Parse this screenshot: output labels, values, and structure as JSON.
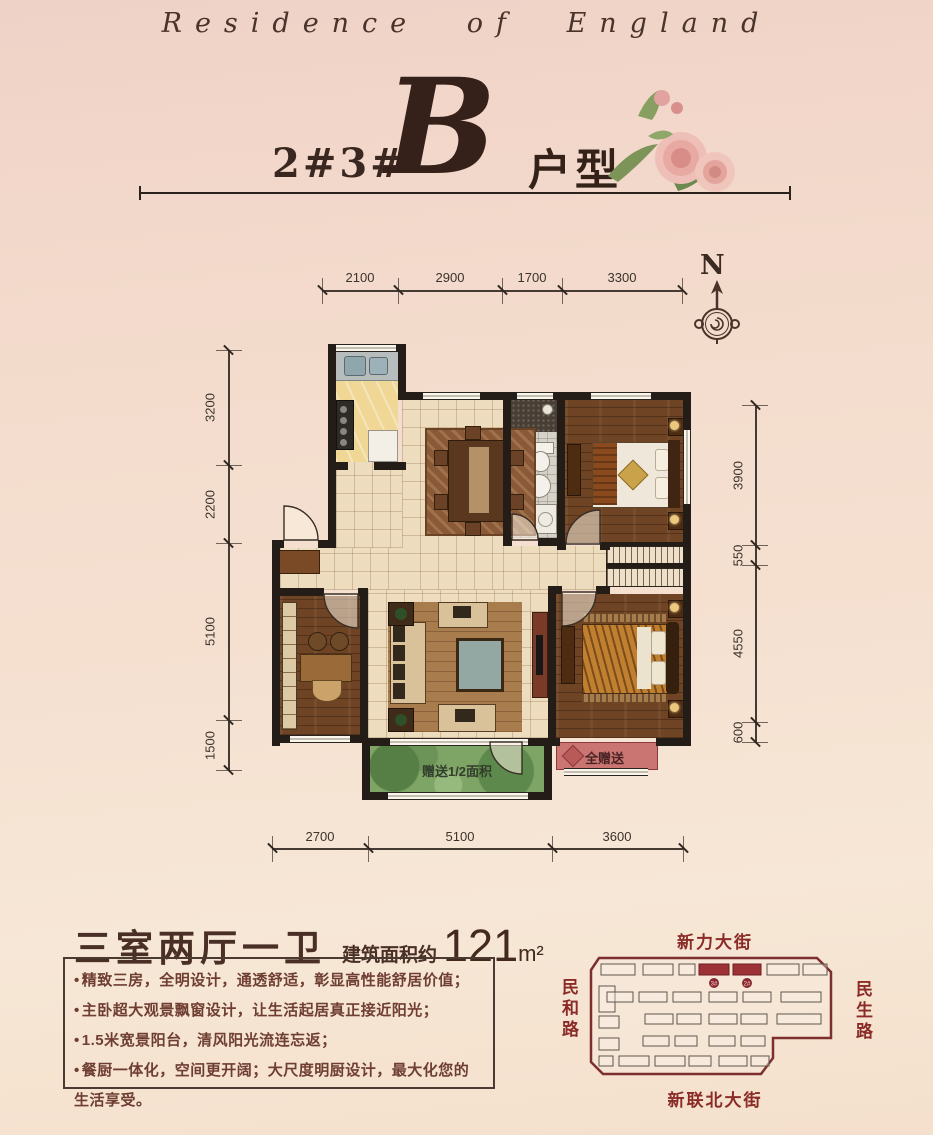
{
  "header": {
    "brand": "Residence of England"
  },
  "title": {
    "prefix": "2#3#",
    "letter": "B",
    "suffix": "户型"
  },
  "compass": {
    "label": "N"
  },
  "dimensions": {
    "top": [
      "2100",
      "2900",
      "1700",
      "3300"
    ],
    "left": [
      "3200",
      "2200",
      "5100",
      "1500"
    ],
    "right": [
      "3900",
      "550",
      "4550",
      "600"
    ],
    "bottom": [
      "2700",
      "5100",
      "3600"
    ]
  },
  "plan": {
    "balcony_label": "赠送1/2面积",
    "bay_window_label": "全赠送"
  },
  "summary": {
    "layout": "三室两厅一卫",
    "area_prefix": "建筑面积约",
    "area_value": "121",
    "area_unit": "m²"
  },
  "features": [
    "精致三房，全明设计，通透舒适，彰显高性能舒居价值；",
    "主卧超大观景飘窗设计，让生活起居真正接近阳光；",
    "1.5米宽景阳台，清风阳光流连忘返；",
    "餐厨一体化，空间更开阔；大尺度明厨设计，最大化您的生活享受。"
  ],
  "sitemap": {
    "street_top": "新力大街",
    "street_bottom": "新联北大街",
    "street_left": "民和路",
    "street_right": "民生路",
    "highlight_buildings": [
      "3#",
      "2#"
    ]
  },
  "colors": {
    "accent_red": "#9c3136",
    "wall": "#241d17",
    "balcony_green": "#7ea566",
    "bay_red": "#cb7572"
  }
}
